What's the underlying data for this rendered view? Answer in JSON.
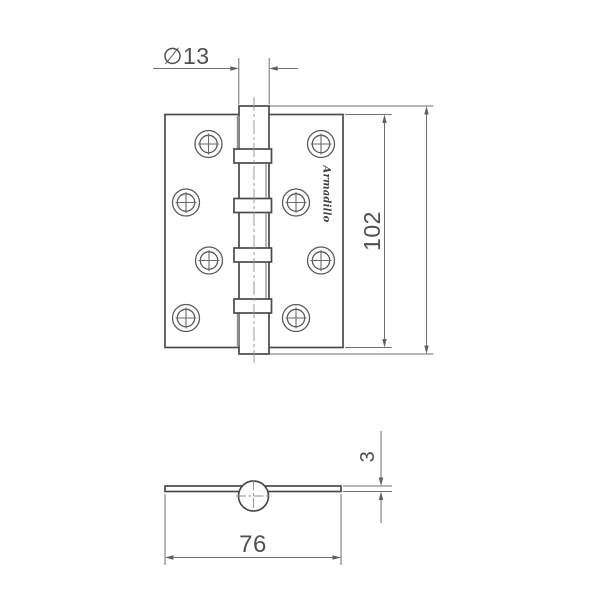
{
  "drawing": {
    "type": "technical-drawing",
    "subject": "butt-hinge",
    "views": {
      "front": {
        "brand_logo": "Armadillo",
        "dimensions": [
          {
            "id": "knuckle-diameter",
            "label": "∅13"
          },
          {
            "id": "leaf-height",
            "label": "102"
          }
        ]
      },
      "side": {
        "dimensions": [
          {
            "id": "leaf-thickness",
            "label": "3"
          },
          {
            "id": "leaf-width",
            "label": "76"
          }
        ]
      }
    },
    "colors": {
      "background": "#ffffff",
      "object_line": "#4a4a4a",
      "dimension_line": "#6f6f6f",
      "text": "#4f4f4f"
    }
  }
}
